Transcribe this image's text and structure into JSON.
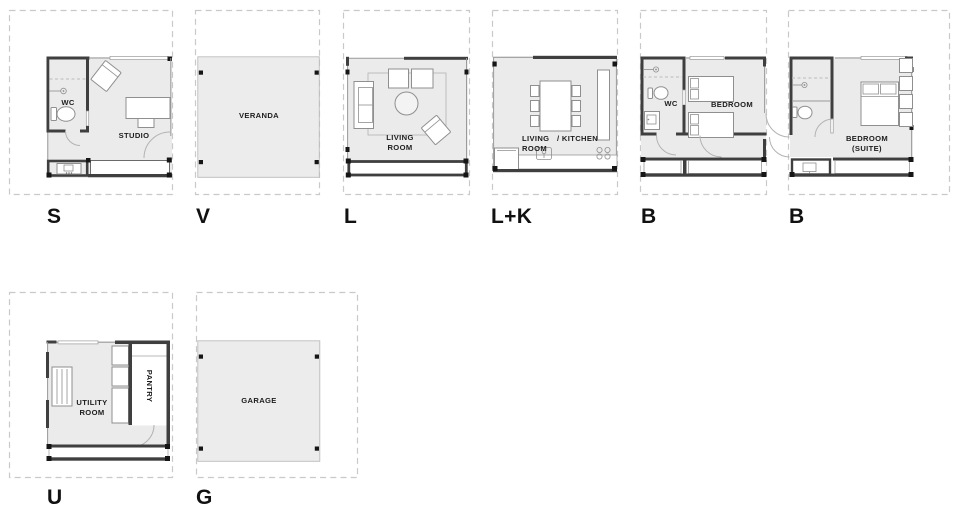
{
  "colors": {
    "background": "#ffffff",
    "floor": "#ebebeb",
    "wall": "#3f3f3f",
    "dashed_outline": "#c9c9c9",
    "furniture_stroke": "#8f8f8f",
    "text": "#1d1d1d"
  },
  "modules": [
    {
      "letter": "S",
      "rooms": {
        "wc": "WC",
        "main": "STUDIO"
      }
    },
    {
      "letter": "V",
      "rooms": {
        "main": "VERANDA"
      }
    },
    {
      "letter": "L",
      "rooms": {
        "main": "LIVING\nROOM"
      }
    },
    {
      "letter": "L+K",
      "rooms": {
        "living": "LIVING\nROOM",
        "kitchen": "/ KITCHEN"
      }
    },
    {
      "letter": "B",
      "rooms": {
        "wc": "WC",
        "main": "BEDROOM"
      }
    },
    {
      "letter": "B",
      "rooms": {
        "main": "BEDROOM\n(SUITE)"
      }
    },
    {
      "letter": "U",
      "rooms": {
        "main": "UTILITY\nROOM",
        "pantry": "PANTRY"
      }
    },
    {
      "letter": "G",
      "rooms": {
        "main": "GARAGE"
      }
    }
  ]
}
